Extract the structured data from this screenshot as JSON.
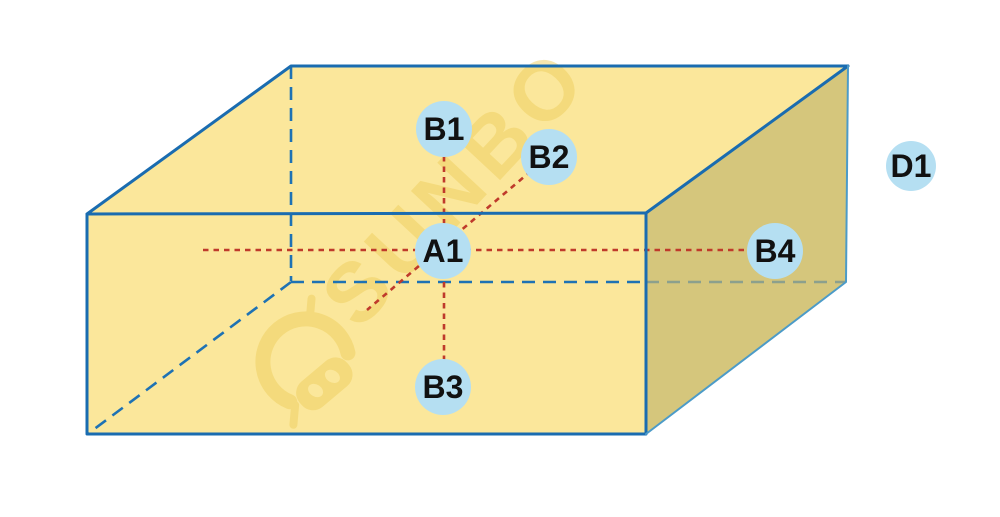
{
  "diagram": {
    "description": "3D carton box with labeled measurement points and dotted measurement axes",
    "points": {
      "A1": {
        "label": "A1",
        "role": "center-point-on-front-face"
      },
      "B1": {
        "label": "B1",
        "role": "point-above-center"
      },
      "B2": {
        "label": "B2",
        "role": "point-diagonal-upper-right"
      },
      "B3": {
        "label": "B3",
        "role": "point-below-center"
      },
      "B4": {
        "label": "B4",
        "role": "point-right-on-side-face"
      },
      "D1": {
        "label": "D1",
        "role": "detached-point-outside-box"
      }
    },
    "watermark": {
      "text": "SUNBO",
      "logo": "robot-head-logo"
    },
    "colors": {
      "face_light": "#FBE79B",
      "face_dark": "#D5C67C",
      "edge_primary": "#1A6CB0",
      "edge_secondary": "#4C9BC8",
      "hidden_edge": "#1E72B4",
      "hidden_edge_muted": "#8CA08D",
      "measure_line": "#BF3A2B",
      "marker_fill": "#B5DFF2",
      "label_color": "#111111",
      "watermark_color": "#EFCF5F"
    }
  }
}
